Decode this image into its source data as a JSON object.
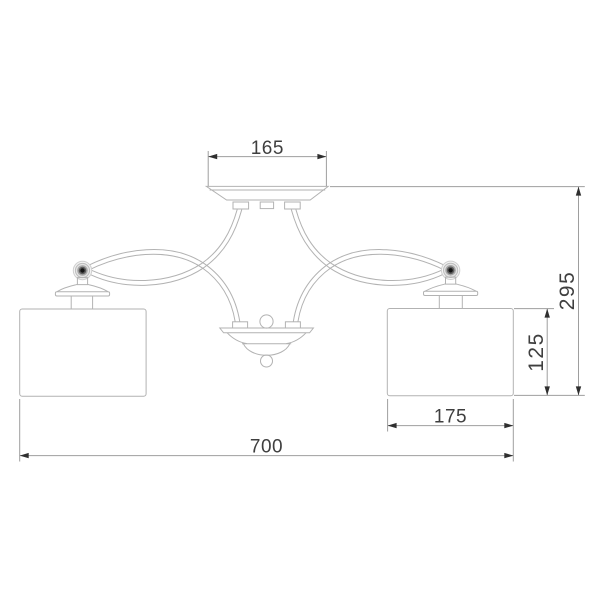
{
  "drawing": {
    "type": "technical-dimension-drawing",
    "subject": "two-shade ceiling chandelier, front elevation",
    "labels": {
      "canopy_width": "165",
      "overall_width": "700",
      "shade_width": "175",
      "shade_height": "125",
      "overall_height": "295"
    },
    "colors": {
      "background": "#ffffff",
      "fixture_outline": "#b2b2b2",
      "dimension_line": "#9e9e9e",
      "arrowhead": "#2f2f2f",
      "label_text": "#3f3f3f",
      "knob_core": "#141414"
    }
  }
}
